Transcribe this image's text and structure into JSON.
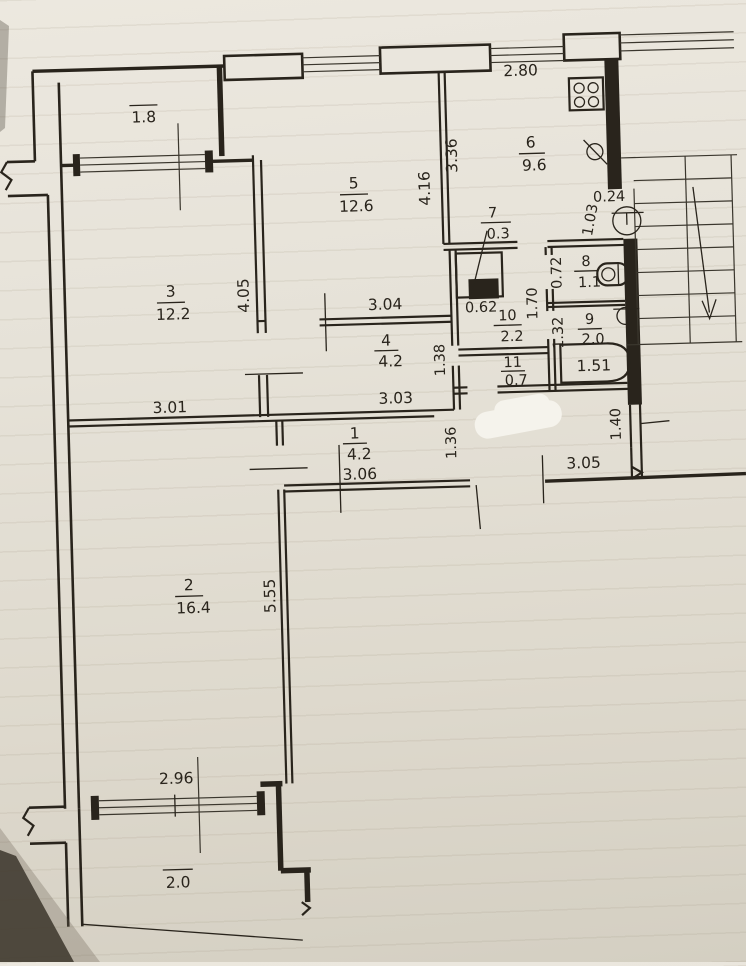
{
  "drawing_title": "apartment floor plan sheet",
  "rooms": [
    {
      "num": "1",
      "area": "4.2"
    },
    {
      "num": "2",
      "area": "16.4"
    },
    {
      "num": "3",
      "area": "12.2"
    },
    {
      "num": "4",
      "area": "4.2"
    },
    {
      "num": "5",
      "area": "12.6"
    },
    {
      "num": "6",
      "area": "9.6"
    },
    {
      "num": "7",
      "area": "0.3"
    },
    {
      "num": "8",
      "area": "1.1"
    },
    {
      "num": "9",
      "area": "2.0"
    },
    {
      "num": "10",
      "area": "2.2"
    },
    {
      "num": "11",
      "area": "0.7"
    }
  ],
  "balconies": [
    {
      "area": "1.8"
    },
    {
      "area": "2.0"
    }
  ],
  "dims": {
    "kitchen_width": "2.80",
    "kitchen_depth": "3.36",
    "room5_depth": "4.16",
    "room5_width": "3.04",
    "room3_depth": "4.05",
    "room3_width": "3.01",
    "room4_width": "3.03",
    "room4_depth": "1.38",
    "closet_width": "0.62",
    "corridor_depth": "1.70",
    "wc_width": "0.72",
    "bath_width": "1.32",
    "tub_length": "1.51",
    "entry_jamb": "0.24",
    "entry_width": "1.03",
    "hall_depth": "1.36",
    "hall_width": "3.06",
    "hall2_width": "3.05",
    "side_door_width": "1.40",
    "room2_depth": "5.55",
    "balcony_window_width": "2.96"
  },
  "icons": {
    "stove": "stove-icon",
    "sink": "sink-icon",
    "toilet": "toilet-icon",
    "basin": "basin-icon",
    "bathtub": "bathtub-icon",
    "stairs_arrow": "stairs-down-arrow-icon",
    "entry_door": "entry-door-swing-icon",
    "wall_break": "wall-break-icon"
  }
}
